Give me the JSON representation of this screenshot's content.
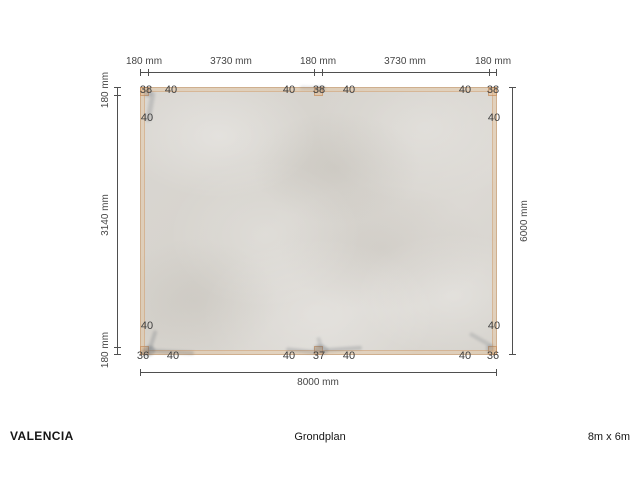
{
  "drawing": {
    "product": "VALENCIA",
    "view": "Grondplan",
    "size": "8m x 6m"
  },
  "dimensions": {
    "top": [
      "180 mm",
      "3730 mm",
      "180 mm",
      "3730 mm",
      "180 mm"
    ],
    "left": [
      "180 mm",
      "3140 mm",
      "180 mm"
    ],
    "right": [
      "6000 mm"
    ],
    "bottom": [
      "8000 mm"
    ]
  },
  "part_numbers": {
    "top_row": [
      "38",
      "40",
      "40",
      "38",
      "40",
      "40",
      "38"
    ],
    "left_col": [
      "40",
      "40"
    ],
    "right_col": [
      "40",
      "40"
    ],
    "bottom_row": [
      "36",
      "40",
      "40",
      "37",
      "40",
      "40",
      "36"
    ]
  },
  "colors": {
    "background": "#ffffff",
    "concrete": "#d8d5d0",
    "beam": "#e8c69e",
    "beam_edge": "#c9905e",
    "dimension_line": "#4f4f4f",
    "text": "#3c3c3c",
    "anchor_shadow": "#5f6670"
  }
}
